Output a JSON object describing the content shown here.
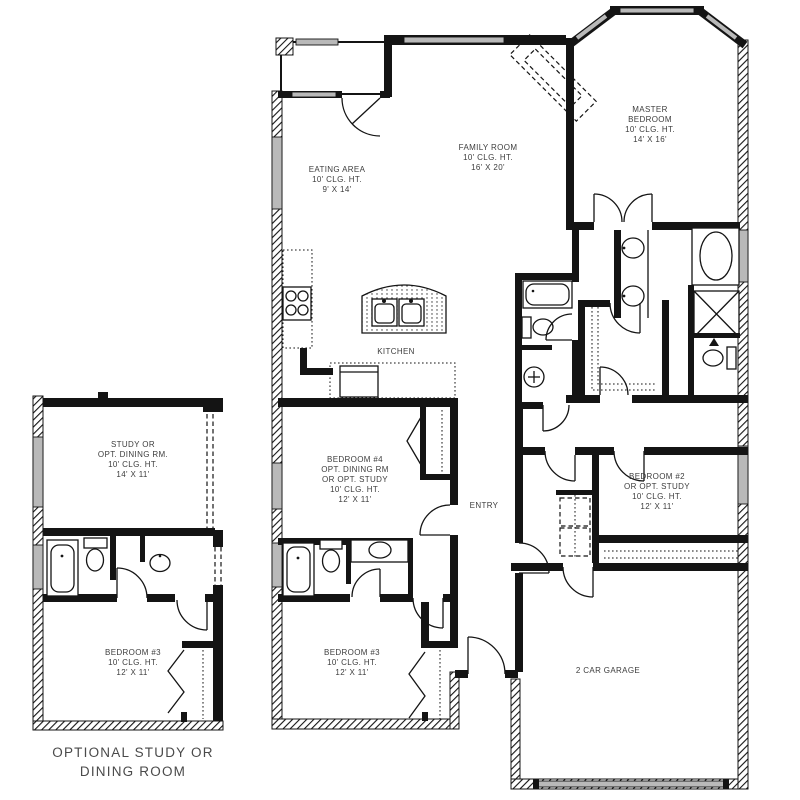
{
  "colors": {
    "wall": "#141414",
    "window": "#b9b9b9",
    "label": "#3d3d3d",
    "caption": "#4a4a4a",
    "bg": "#ffffff"
  },
  "main_plan": {
    "rooms": {
      "eating_area": [
        "EATING AREA",
        "10' CLG. HT.",
        "9' X 14'"
      ],
      "family_room": [
        "FAMILY ROOM",
        "10' CLG. HT.",
        "16' X 20'"
      ],
      "master_bedroom": [
        "MASTER",
        "BEDROOM",
        "10' CLG. HT.",
        "14' X 16'"
      ],
      "kitchen": [
        "KITCHEN"
      ],
      "bedroom4": [
        "BEDROOM #4",
        "OPT. DINING RM",
        "OR OPT. STUDY",
        "10' CLG. HT.",
        "12' X 11'"
      ],
      "entry": [
        "ENTRY"
      ],
      "bedroom2": [
        "BEDROOM #2",
        "OR OPT. STUDY",
        "10' CLG. HT.",
        "12' X 11'"
      ],
      "bedroom3": [
        "BEDROOM #3",
        "10' CLG. HT.",
        "12' X 11'"
      ],
      "garage": [
        "2 CAR GARAGE"
      ]
    }
  },
  "optional_plan": {
    "rooms": {
      "study": [
        "STUDY OR",
        "OPT. DINING RM.",
        "10' CLG. HT.",
        "14' X 11'"
      ],
      "bedroom3": [
        "BEDROOM #3",
        "10' CLG. HT.",
        "12' X 11'"
      ]
    },
    "caption": [
      "OPTIONAL STUDY OR",
      "DINING ROOM"
    ]
  }
}
